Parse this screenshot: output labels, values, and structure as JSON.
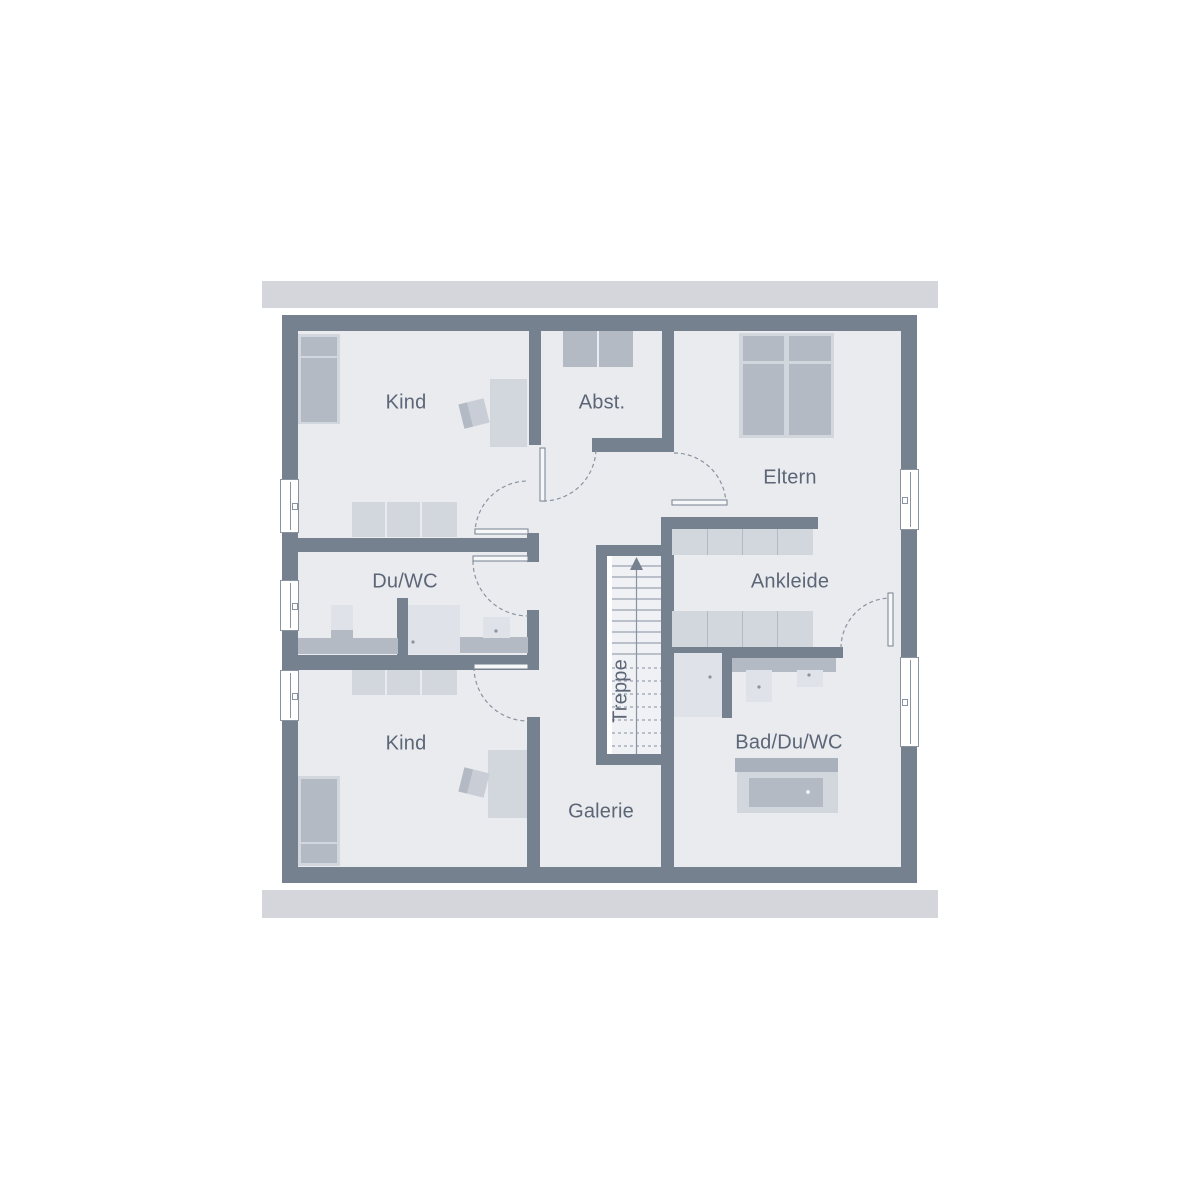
{
  "colors": {
    "wall": "#76818F",
    "floor": "#E9EBEF",
    "eaves": "#D4D6DB",
    "furniture-light": "#D2D6DD",
    "furniture-medium": "#B3BAC4",
    "furniture-dark": "#A9B1BC",
    "fixture": "#DFE2E8",
    "divider": "#E9EBEF",
    "outline": "#8A93A0",
    "label-text": "#5C6676",
    "stair-bg": "#EFF1F5"
  },
  "floorplan": {
    "rooms": {
      "kind_top": {
        "label": "Kind"
      },
      "abstellraum": {
        "label": "Abst."
      },
      "eltern": {
        "label": "Eltern"
      },
      "du_wc": {
        "label": "Du/WC"
      },
      "ankleide": {
        "label": "Ankleide"
      },
      "treppe": {
        "label": "Treppe"
      },
      "kind_bottom": {
        "label": "Kind"
      },
      "galerie": {
        "label": "Galerie"
      },
      "bad_du_wc": {
        "label": "Bad/Du/WC"
      }
    }
  }
}
